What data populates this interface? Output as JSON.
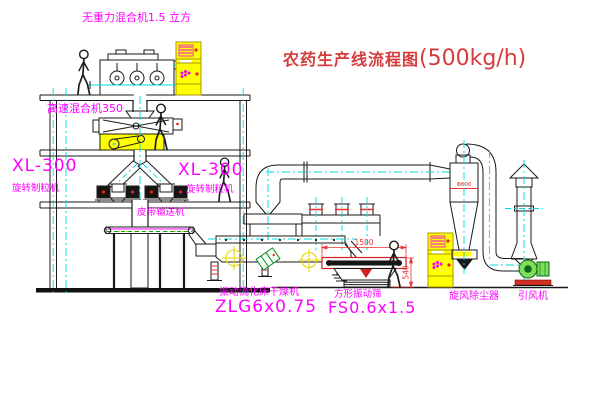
{
  "title": {
    "text": "农药生产线流程图",
    "capacity": "(500kg/h)"
  },
  "labels": {
    "gravity_mixer": "无重力混合机1.5 立方",
    "highspeed_mixer": "高速混合机350",
    "xl300_left": "XL-300",
    "granulator_left": "旋转制粒机",
    "xl300_right": "XL-300",
    "granulator_right": "旋转制粒机",
    "belt_conveyor": "皮带输送机",
    "dryer_name": "振动流化床干燥机",
    "dryer_model": "ZLG6x0.75",
    "sieve_name": "方形振动筛",
    "sieve_model": "FS0.6x1.5",
    "cyclone": "旋风除尘器",
    "fan": "引风机"
  },
  "dims": {
    "sieve_length": "1500",
    "sieve_height": "540",
    "cyclone_note": "Φ600"
  },
  "colors": {
    "annotation_magenta": "#ff00ff",
    "title_red": "#d63c3c",
    "centerline_cyan": "#00dcdc",
    "cabinet_yellow": "#ffff00",
    "dimension_red": "#ee3333",
    "fan_green": "#7ede5a"
  }
}
